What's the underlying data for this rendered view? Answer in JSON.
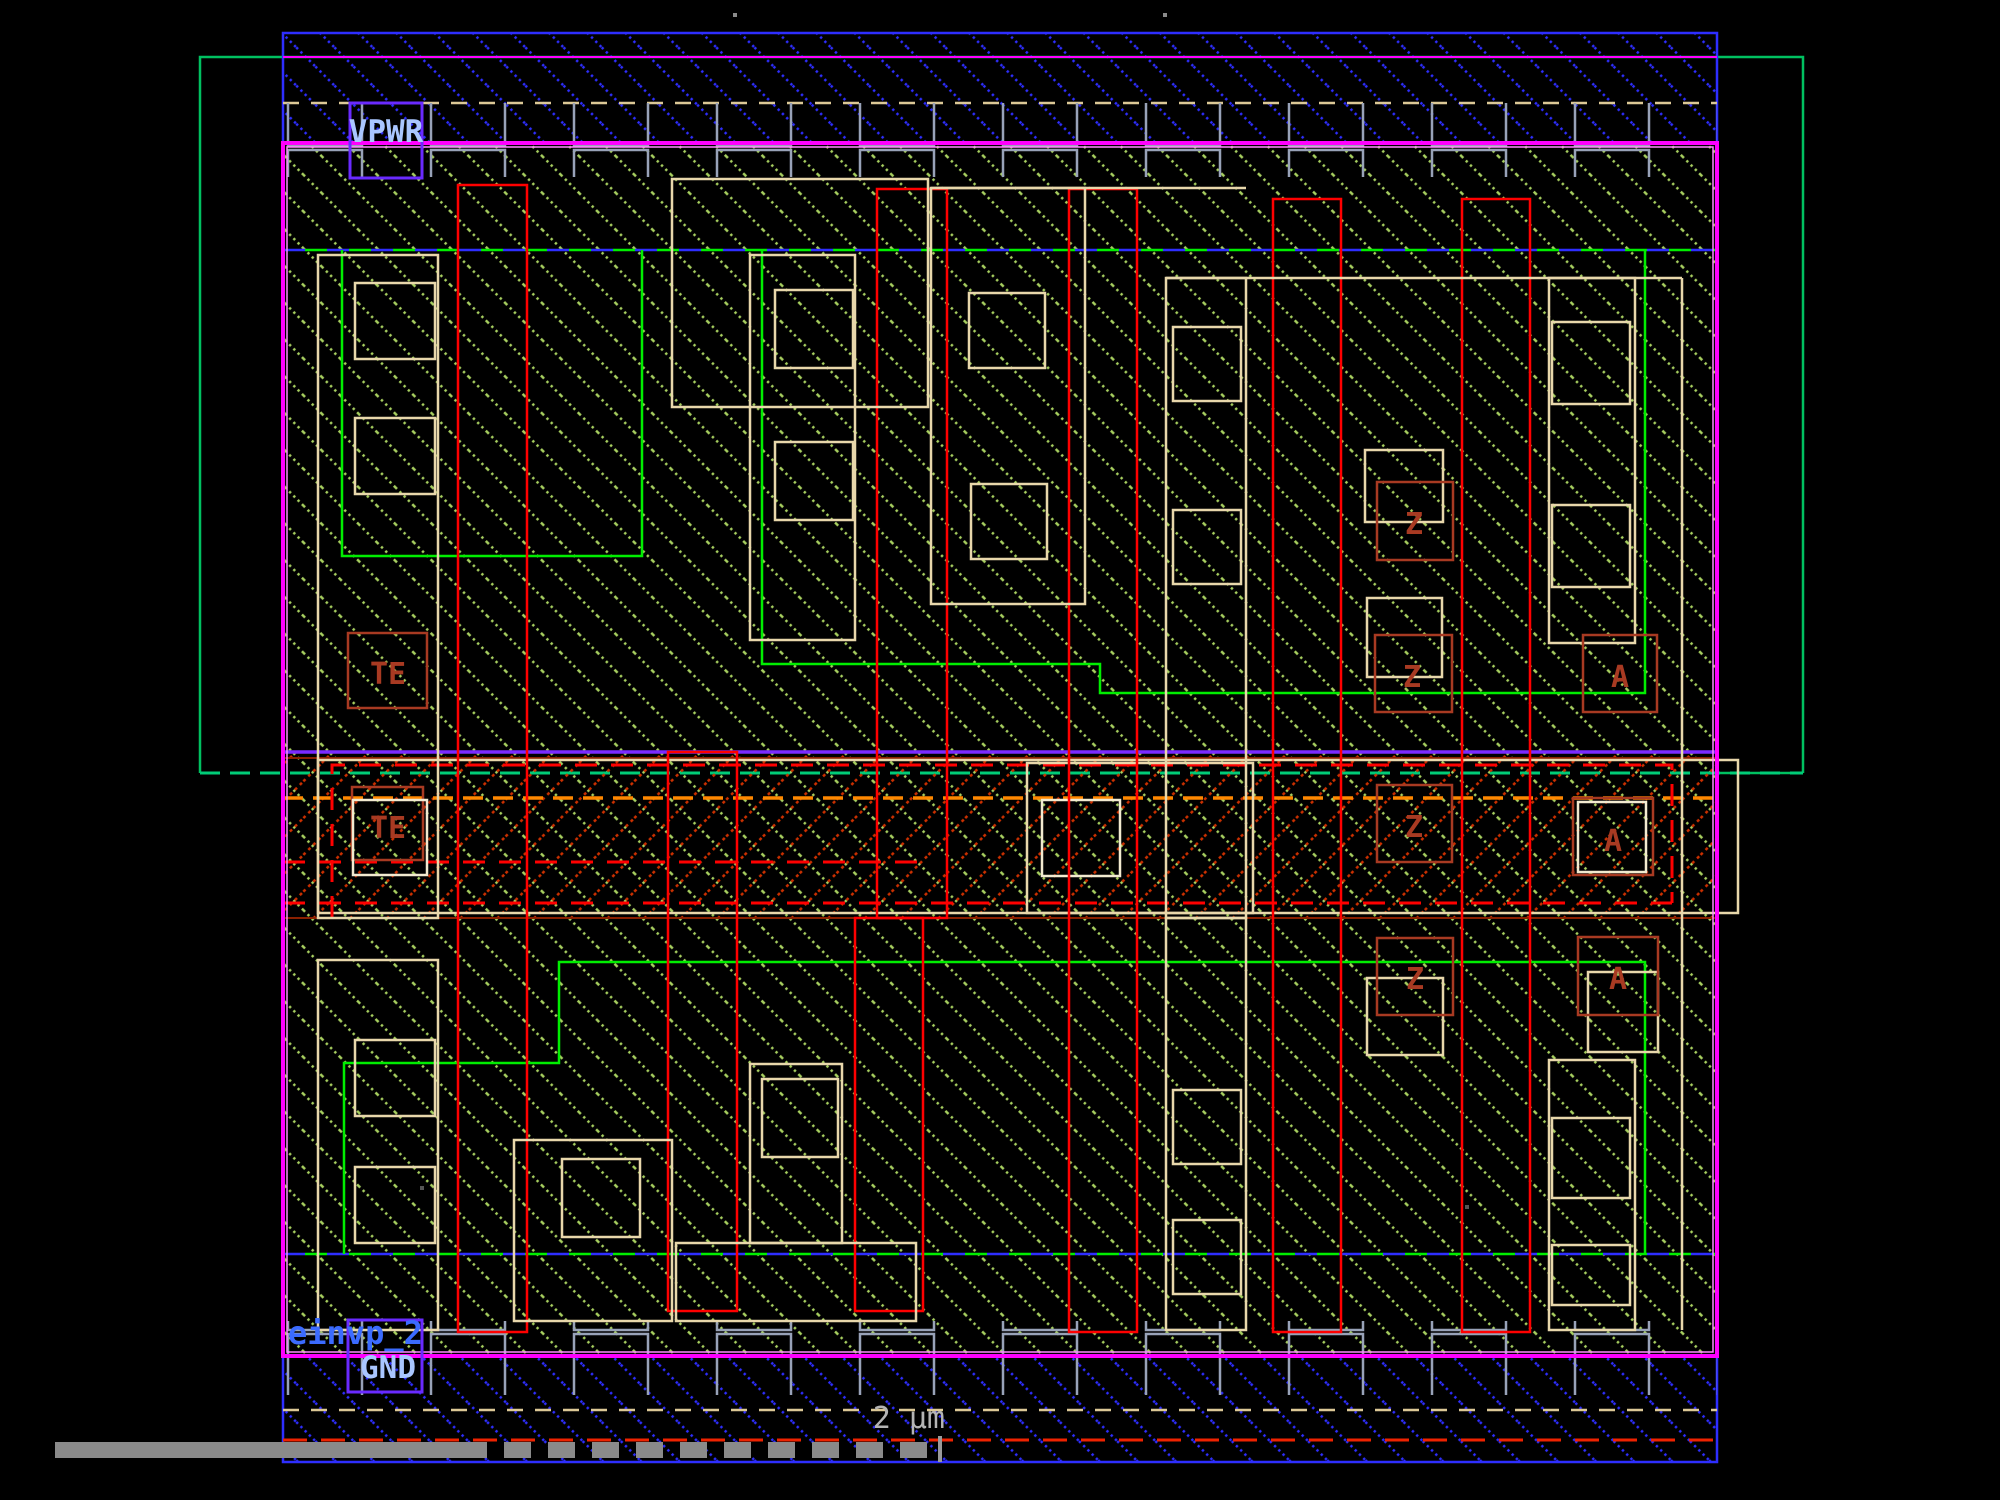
{
  "viewer": {
    "type": "ic-layout-view",
    "cell_name": "einvp_2"
  },
  "labels": {
    "power_rail": "VPWR",
    "ground_rail": "GND",
    "cell_name": "einvp_2",
    "pin_te": "TE",
    "pin_a": "A",
    "pin_z": "Z",
    "scale": "2 µm"
  },
  "colors": {
    "background": "#000000",
    "metal1_blue": "#2e2eff",
    "nwell_green": "#00c060",
    "diffusion_green": "#00ee00",
    "poly_red": "#ff0000",
    "pin_box_dark_red": "#a83a22",
    "li_tan": "#e8d7ab",
    "via_gray": "#98a2b8",
    "boundary_magenta": "#ff00ff",
    "hatch_green": "#a8d060",
    "hatch_red": "#cc3000",
    "select_purple": "#7a2aff",
    "npc_orange": "#ff8800",
    "cellname_blue": "#3b6bff",
    "port_lightblue": "#a9c6ff",
    "scale_gray": "#b4b4b4"
  }
}
